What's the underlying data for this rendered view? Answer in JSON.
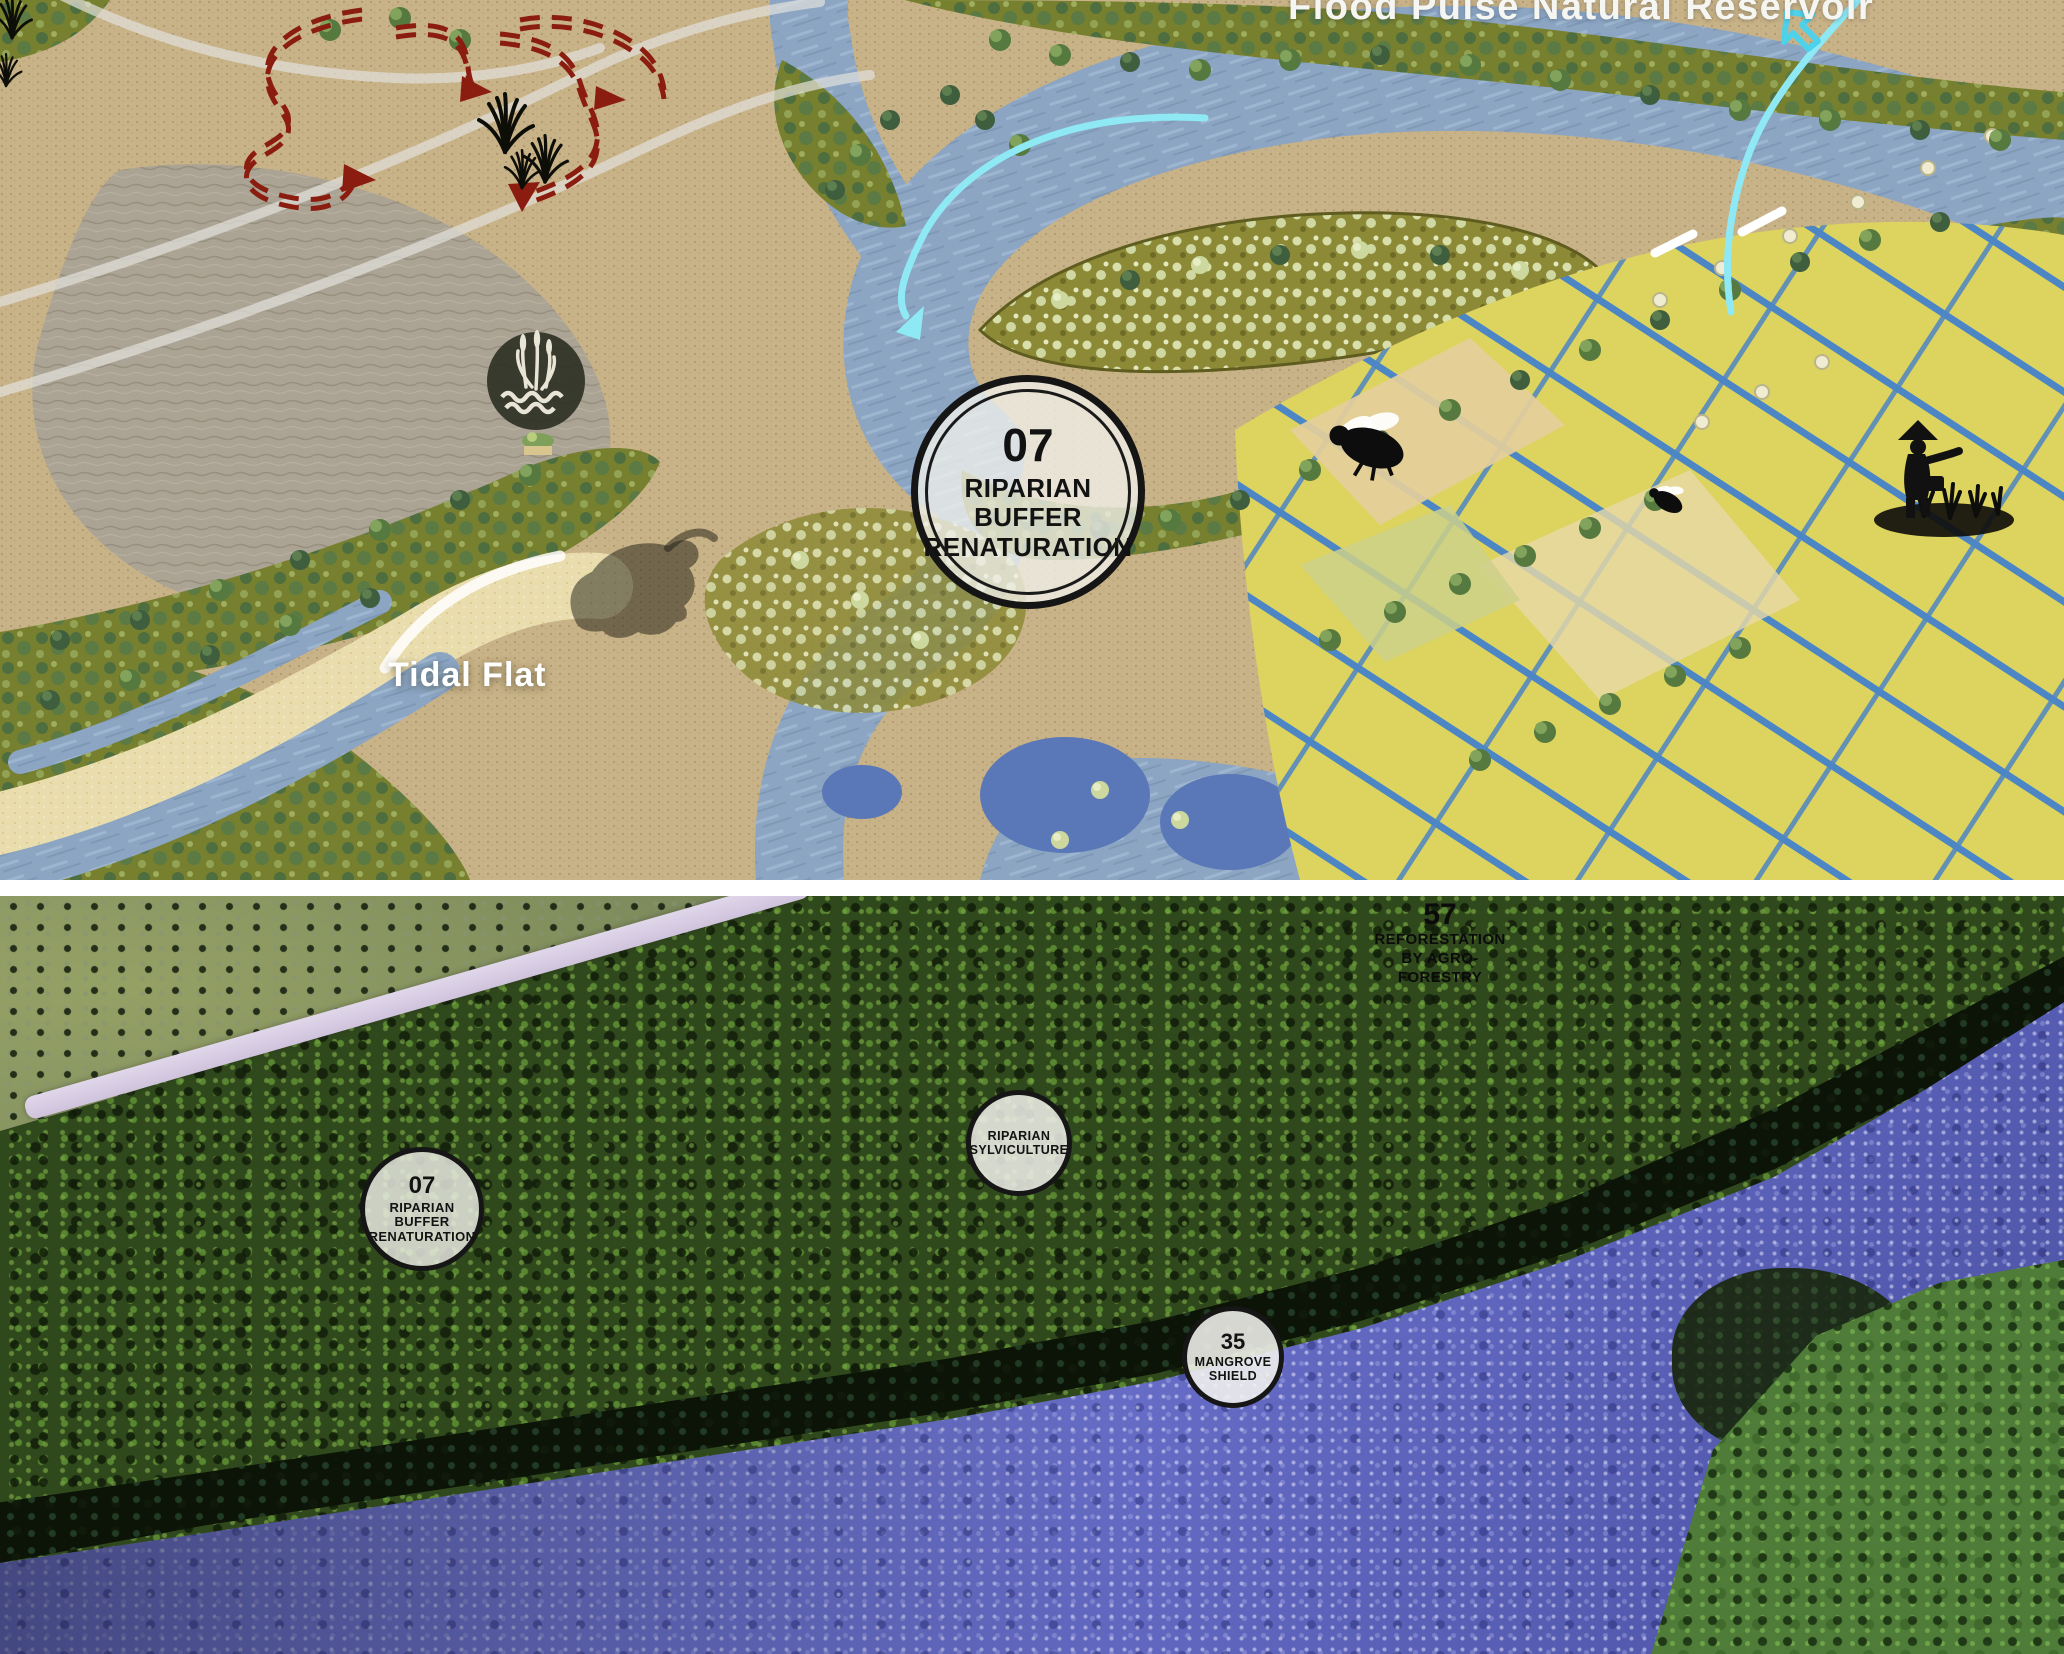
{
  "top_panel": {
    "reservoir_label": "Flood Pulse Natural Reservoir",
    "tidal_flat_label": "Tidal Flat",
    "badge": {
      "number": "07",
      "line1": "RIPARIAN",
      "line2": "BUFFER",
      "line3": "RENATURATION"
    }
  },
  "bottom_panel": {
    "badge_riparian": {
      "number": "07",
      "line1": "RIPARIAN",
      "line2": "BUFFER",
      "line3": "RENATURATION"
    },
    "badge_sylviculture": {
      "line1": "RIPARIAN",
      "line2": "SYLVICULTURE"
    },
    "badge_mangrove": {
      "number": "35",
      "line1": "MANGROVE",
      "line2": "SHIELD"
    },
    "annotation_reforestation": {
      "number": "57",
      "line1": "REFORESTATION",
      "line2": "BY AGRO-",
      "line3": "FORESTRY"
    }
  },
  "colors": {
    "flow_accent_cyan": "#6fdef0",
    "route_maroon": "#8a1d10",
    "plan_river_blue": "#8ba5c3",
    "perspective_river_violet": "#6a70c8",
    "field_yellow": "#ddd35f"
  }
}
